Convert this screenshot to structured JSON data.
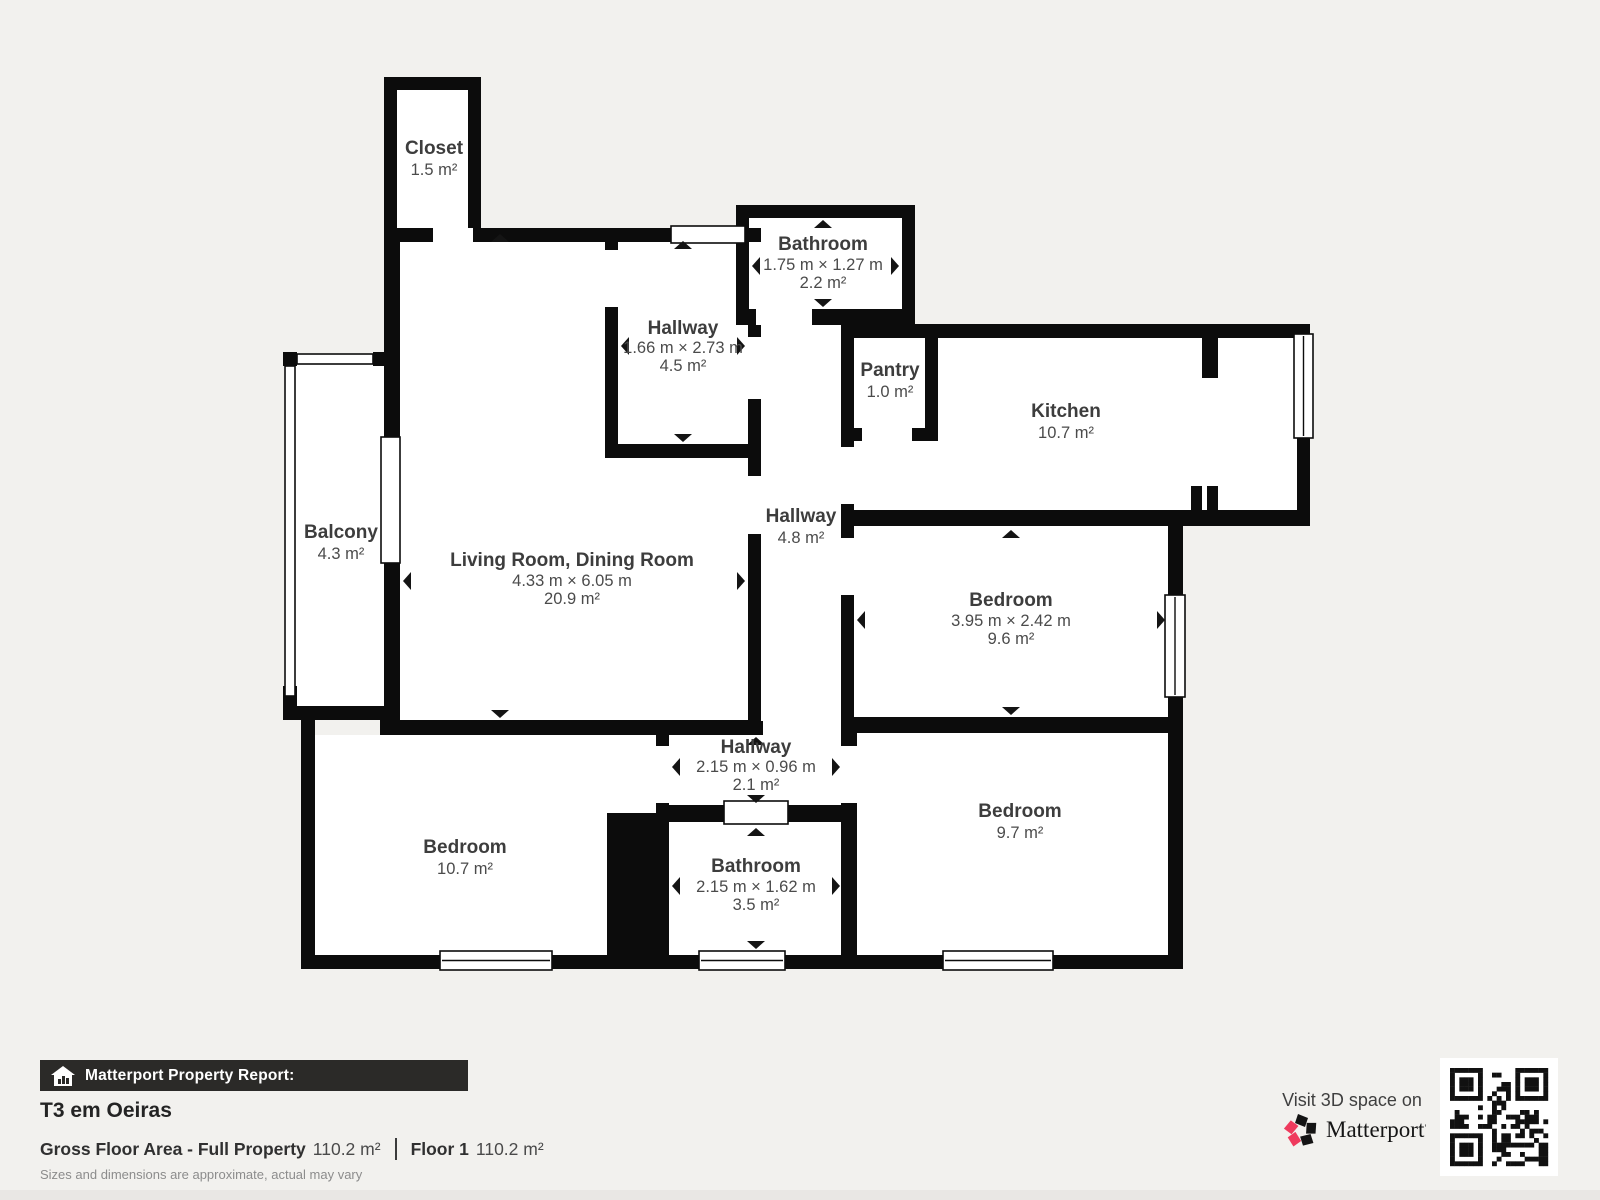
{
  "colors": {
    "background": "#f2f1ee",
    "wall": "#0c0c0c",
    "room_fill": "#ffffff",
    "name_text": "#3d3d3d",
    "dim_text": "#4b4b4b",
    "bar_bg": "#2b2a28",
    "brand_pink": "#ef3a5d"
  },
  "rooms": [
    {
      "name": "Closet",
      "area": "1.5 m²"
    },
    {
      "name": "Hallway",
      "dims": "1.66 m × 2.73 m",
      "area": "4.5 m²"
    },
    {
      "name": "Bathroom",
      "dims": "1.75 m × 1.27 m",
      "area": "2.2 m²"
    },
    {
      "name": "Pantry",
      "area": "1.0 m²"
    },
    {
      "name": "Kitchen",
      "area": "10.7 m²"
    },
    {
      "name": "Balcony",
      "area": "4.3 m²"
    },
    {
      "name": "Living Room, Dining Room",
      "dims": "4.33 m × 6.05 m",
      "area": "20.9 m²"
    },
    {
      "name": "Hallway",
      "area": "4.8 m²"
    },
    {
      "name": "Bedroom",
      "dims": "3.95 m × 2.42 m",
      "area": "9.6 m²"
    },
    {
      "name": "Hallway",
      "dims": "2.15 m × 0.96 m",
      "area": "2.1 m²"
    },
    {
      "name": "Bedroom",
      "area": "10.7 m²"
    },
    {
      "name": "Bathroom",
      "dims": "2.15 m × 1.62 m",
      "area": "3.5 m²"
    },
    {
      "name": "Bedroom",
      "area": "9.7 m²"
    }
  ],
  "footer": {
    "report_label": "Matterport Property Report:",
    "title": "T3 em Oeiras",
    "gfa_label": "Gross Floor Area - Full Property",
    "gfa_value": "110.2 m²",
    "floor_label": "Floor 1",
    "floor_value": "110.2 m²",
    "disclaimer": "Sizes and dimensions are approximate, actual may vary",
    "visit_label": "Visit 3D space on",
    "brand": "Matterport"
  }
}
